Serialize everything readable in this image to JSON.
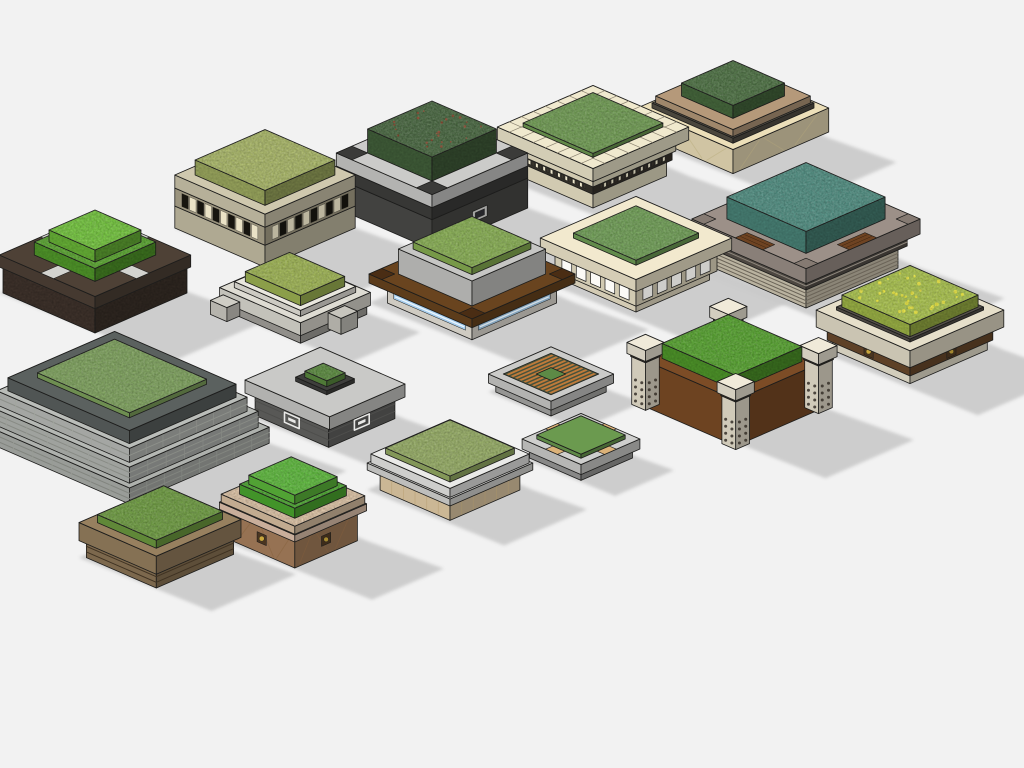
{
  "scene": {
    "description": "Isometric 3D render of a collection of 18 square landscape planter models with grass and shrub tops",
    "background": "#f2f2f2",
    "shadow_color": "#c9c9c9",
    "edge_color": "#1d1d1c",
    "planters": [
      {
        "id": "beige-slat-band",
        "label": "beige planter with slat band",
        "cx": 265,
        "cy": 228,
        "tiers": [
          {
            "w": 49,
            "d": 49,
            "h": 22,
            "c": "#c7c0a6"
          },
          {
            "w": 49,
            "d": 49,
            "h": 18,
            "c": "#b0a88f",
            "studs": {
              "n": 5,
              "c1": "#17150f",
              "c2": "#eae2c6"
            }
          },
          {
            "w": 49,
            "d": 49,
            "h": 13,
            "c": "#cfc8ae"
          },
          {
            "w": 38,
            "d": 38,
            "h": 15,
            "c": "#a9b767",
            "tex": 1
          }
        ]
      },
      {
        "id": "charcoal-concrete",
        "label": "charcoal planter with concrete top ring",
        "cx": 432,
        "cy": 208,
        "tiers": [
          {
            "w": 52,
            "d": 52,
            "h": 30,
            "c": "#4b4b49",
            "plaque": {
              "c": "#a3a3a1"
            }
          },
          {
            "w": 52,
            "d": 52,
            "h": 12,
            "c": "#3e3e3c"
          },
          {
            "w": 52,
            "d": 52,
            "h": 13,
            "c": "#cbcbc9",
            "pads": {
              "s": 17,
              "c": "#3b3b39"
            }
          },
          {
            "w": 35,
            "d": 35,
            "h": 24,
            "c": "#47663f",
            "tex": 1,
            "dots": {
              "n": 24,
              "c": "#8a4a30",
              "r": 1.1
            }
          }
        ]
      },
      {
        "id": "cream-tile",
        "label": "cream classical planter with tile border",
        "cx": 593,
        "cy": 176,
        "tiers": [
          {
            "w": 40,
            "d": 40,
            "h": 16,
            "c": "#ede6c9"
          },
          {
            "w": 43,
            "d": 43,
            "h": 9,
            "c": "#39352d",
            "studs": {
              "n": 9,
              "c1": "#efe8cd",
              "c2": "#39352d"
            }
          },
          {
            "w": 45,
            "d": 45,
            "h": 7,
            "c": "#ede6c9"
          },
          {
            "w": 47,
            "d": 47,
            "h": 4,
            "c": "#46423a"
          },
          {
            "w": 52,
            "d": 52,
            "h": 13,
            "c": "#f0e9ce",
            "tiles": {
              "ti": 38,
              "n": 8,
              "c": "#8a8270"
            }
          },
          {
            "w": 38,
            "d": 38,
            "h": 4,
            "c": "#6f9b52",
            "tex": 1
          }
        ]
      },
      {
        "id": "faceted-pedestal",
        "label": "faceted cream pedestal planter",
        "cx": 733,
        "cy": 138,
        "tiers": [
          {
            "w": 26,
            "d": 26,
            "h": 6,
            "c": "#e6dab2"
          },
          {
            "w": 52,
            "d": 52,
            "h": 24,
            "c": "#ecdfb9",
            "facets": {
              "c": "#c4b88f"
            }
          },
          {
            "w": 44,
            "d": 44,
            "h": 5,
            "c": "#544f45"
          },
          {
            "w": 42,
            "d": 42,
            "h": 7,
            "c": "#b5997a"
          },
          {
            "w": 28,
            "d": 28,
            "h": 13,
            "c": "#4c7042",
            "tex": 1
          }
        ]
      },
      {
        "id": "teal-mosaic",
        "label": "taupe planter with teal shrubs and wood strips",
        "cx": 806,
        "cy": 268,
        "tiers": [
          {
            "w": 50,
            "d": 50,
            "h": 22,
            "c": "#d2cab5",
            "stripes": {
              "n": 5,
              "c": "#6b6458"
            }
          },
          {
            "w": 55,
            "d": 55,
            "h": 12,
            "c": "#57514a",
            "stripes": {
              "n": 2,
              "c": "#8d867c"
            }
          },
          {
            "w": 62,
            "d": 62,
            "h": 15,
            "c": "#9c9088",
            "strips": {
              "len": 30,
              "wd": 13,
              "c": "#6e4322",
              "lines": "#3c2410"
            },
            "pads": {
              "s": 13,
              "c": "#857a72"
            }
          },
          {
            "w": 43,
            "d": 43,
            "h": 22,
            "c": "#4f8d80",
            "tex": 1
          }
        ]
      },
      {
        "id": "soil-cross",
        "label": "dark soil planter with stone cross paths",
        "cx": 95,
        "cy": 293,
        "tiers": [
          {
            "w": 50,
            "d": 50,
            "h": 26,
            "c": "#463931",
            "texS": 1
          },
          {
            "w": 52,
            "d": 52,
            "h": 12,
            "c": "#4e4136",
            "cross": {
              "wd": 14,
              "c": "#d3d3cf"
            }
          },
          {
            "w": 33,
            "d": 33,
            "h": 13,
            "c": "#58a52e",
            "tex": 1
          },
          {
            "w": 25,
            "d": 25,
            "h": 12,
            "c": "#72c43c",
            "tex": 1
          }
        ]
      },
      {
        "id": "white-low-steps",
        "label": "low white planter with steps",
        "cx": 295,
        "cy": 312,
        "tiers": [
          {
            "w": 42,
            "d": 36,
            "h": 9,
            "c": "#a5a39d"
          },
          {
            "w": 44,
            "d": 38,
            "h": 13,
            "c": "#dedcd3"
          },
          {
            "w": 36,
            "d": 30,
            "h": 6,
            "c": "#e9e7de"
          },
          {
            "w": 30,
            "d": 24,
            "h": 10,
            "c": "#9eb453",
            "tex": 1
          }
        ],
        "blocks": [
          {
            "a": -34,
            "b": 42,
            "w": 9,
            "d": 7,
            "h": 14,
            "c": "#cfcdc5"
          },
          {
            "a": 46,
            "b": -6,
            "w": 7,
            "d": 9,
            "h": 16,
            "c": "#c7c5bd"
          }
        ]
      },
      {
        "id": "wood-led",
        "label": "wood frame planter with LED strip base",
        "cx": 472,
        "cy": 303,
        "tiers": [
          {
            "w": 46,
            "d": 46,
            "h": 20,
            "c": "#ebe7dd",
            "band": {
              "c": "#a9cfee",
              "core": "#eaf5fd"
            }
          },
          {
            "w": 56,
            "d": 56,
            "h": 9,
            "c": "#69441f",
            "pads": {
              "s": 14,
              "c": "#4a2d14"
            }
          },
          {
            "w": 40,
            "d": 40,
            "h": 25,
            "c": "#c6c6c4"
          },
          {
            "w": 32,
            "d": 32,
            "h": 7,
            "c": "#87ae52",
            "tex": 1
          }
        ]
      },
      {
        "id": "cream-arcade",
        "label": "cream planter with arched arcade",
        "cx": 636,
        "cy": 280,
        "tiers": [
          {
            "w": 40,
            "d": 40,
            "h": 9,
            "c": "#f0e7cc"
          },
          {
            "w": 44,
            "d": 44,
            "h": 21,
            "c": "#eee5ca",
            "arches": {
              "n": 5,
              "c": "#fbfaf6"
            }
          },
          {
            "w": 52,
            "d": 52,
            "h": 12,
            "c": "#f2e9ce"
          },
          {
            "w": 34,
            "d": 34,
            "h": 5,
            "c": "#6f9e55",
            "tex": 1
          }
        ]
      },
      {
        "id": "wood-pillars",
        "label": "wood planter with stone corner pillars",
        "cx": 732,
        "cy": 406,
        "tiers": [
          {
            "w": 52,
            "d": 48,
            "h": 46,
            "c": "#7c4c26"
          },
          {
            "w": 40,
            "d": 36,
            "h": 15,
            "c": "#55a22e",
            "tex": 1
          }
        ],
        "posts": {
          "s": 15,
          "h": 62,
          "c": "#ece5d2",
          "at": [
            {
              "a": -49,
              "b": -45,
              "z": "back"
            },
            {
              "a": 49,
              "b": -45,
              "z": "mid",
              "holes": 1
            },
            {
              "a": -49,
              "b": 45,
              "z": "mid",
              "holes": 1
            },
            {
              "a": 49,
              "b": 45,
              "z": "front",
              "holes": 1
            }
          ]
        }
      },
      {
        "id": "travertine-flowers",
        "label": "travertine planter with flowering lawn",
        "cx": 910,
        "cy": 350,
        "tiers": [
          {
            "w": 42,
            "d": 42,
            "h": 10,
            "c": "#efe9d6"
          },
          {
            "w": 45,
            "d": 45,
            "h": 13,
            "c": "#6b4a2c",
            "medallion": {
              "c": "#c9a63c"
            }
          },
          {
            "w": 51,
            "d": 51,
            "h": 17,
            "c": "#e6dfca"
          },
          {
            "w": 40,
            "d": 40,
            "h": 3,
            "c": "#55504a"
          },
          {
            "w": 37,
            "d": 37,
            "h": 12,
            "c": "#a9c24c",
            "tex": 1,
            "dots": {
              "n": 34,
              "c": "#e9e53f",
              "r": 1.5
            }
          }
        ]
      },
      {
        "id": "stone-pyramid",
        "label": "stepped stone pyramid planter",
        "cx": 122,
        "cy": 440,
        "tiers": [
          {
            "w": 84,
            "d": 76,
            "h": 16,
            "c": "#aeb1ad",
            "stripes": {
              "n": 2,
              "c": "#82857f"
            },
            "panels": {
              "n": 7,
              "c": "#989b95"
            }
          },
          {
            "w": 78,
            "d": 70,
            "h": 16,
            "c": "#b5b8b4",
            "stripes": {
              "n": 2,
              "c": "#888b85"
            },
            "panels": {
              "n": 6,
              "c": "#9da09a"
            }
          },
          {
            "w": 72,
            "d": 64,
            "h": 14,
            "c": "#babdb9",
            "stripes": {
              "n": 1,
              "c": "#8d908a"
            },
            "panels": {
              "n": 6,
              "c": "#a2a59f"
            }
          },
          {
            "w": 66,
            "d": 58,
            "h": 13,
            "c": "#5b615f"
          },
          {
            "w": 50,
            "d": 42,
            "h": 5,
            "c": "#7da15c",
            "tex": 1
          }
        ]
      },
      {
        "id": "concrete-inset",
        "label": "concrete slab planter with inset shrub",
        "cx": 325,
        "cy": 417,
        "tiers": [
          {
            "w": 40,
            "d": 36,
            "h": 22,
            "c": "#646462",
            "stripes": {
              "n": 2,
              "c": "#4e4e4c"
            },
            "plaque": {
              "c": "#e8e8e6",
              "key": 1
            },
            "plaqueL": 1
          },
          {
            "w": 46,
            "d": 41,
            "h": 13,
            "c": "#c9c9c7"
          },
          {
            "w": 17,
            "d": 15,
            "h": 4,
            "c": "#3f3f3d"
          },
          {
            "w": 12,
            "d": 10,
            "h": 6,
            "c": "#5a8a3e",
            "tex": 1
          }
        ]
      },
      {
        "id": "wood-lattice",
        "label": "flat planter with wood slat lattice",
        "cx": 551,
        "cy": 392,
        "tiers": [
          {
            "w": 30,
            "d": 30,
            "h": 9,
            "c": "#a9a9a7"
          },
          {
            "w": 34,
            "d": 34,
            "h": 9,
            "c": "#cbcbc9",
            "lattice": {
              "iw": 26,
              "idp": 26,
              "wood": "#bf7a3a",
              "gap": "#46523c",
              "center": "#5d8a46",
              "cw": 8
            }
          }
        ]
      },
      {
        "id": "frame-clips",
        "label": "gray frame planter with timber clips",
        "cx": 581,
        "cy": 458,
        "tiers": [
          {
            "w": 28,
            "d": 28,
            "h": 9,
            "c": "#9b9b99"
          },
          {
            "w": 32,
            "d": 32,
            "h": 10,
            "c": "#cfcfcd",
            "strips": {
              "len": 13,
              "wd": 8,
              "c": "#dcb278"
            }
          },
          {
            "w": 24,
            "d": 24,
            "h": 4,
            "c": "#6b9a4f"
          }
        ]
      },
      {
        "id": "brown-grass",
        "label": "brown banded planter with lawn",
        "cx": 160,
        "cy": 556,
        "tiers": [
          {
            "w": 38,
            "d": 42,
            "h": 17,
            "c": "#8d7657",
            "stripes": {
              "n": 2,
              "c": "#3f3222"
            }
          },
          {
            "w": 42,
            "d": 46,
            "h": 18,
            "c": "#97805f"
          },
          {
            "w": 32,
            "d": 36,
            "h": 8,
            "c": "#6d9b40",
            "tex": 1
          }
        ]
      },
      {
        "id": "quilted-mound",
        "label": "quilted tan planter with shrub mound",
        "cx": 293,
        "cy": 540,
        "tiers": [
          {
            "w": 36,
            "d": 34,
            "h": 30,
            "c": "#aa825e",
            "medallion": {
              "c": "#c9a63c"
            },
            "facets": {
              "c": "#8e6a48"
            }
          },
          {
            "w": 41,
            "d": 39,
            "h": 7,
            "c": "#e4c6b0"
          },
          {
            "w": 40,
            "d": 38,
            "h": 8,
            "c": "#dcc2a4",
            "tex": 1
          },
          {
            "w": 30,
            "d": 28,
            "h": 10,
            "c": "#4ba72f",
            "tex": 1
          },
          {
            "w": 25,
            "d": 23,
            "h": 9,
            "c": "#5cb83b",
            "tex": 1
          }
        ]
      },
      {
        "id": "white-stone-base",
        "label": "white planter on tan stone base",
        "cx": 450,
        "cy": 490,
        "tiers": [
          {
            "w": 38,
            "d": 38,
            "h": 20,
            "c": "#e7d0a9",
            "panels": {
              "n": 5,
              "c": "#bfa87f"
            }
          },
          {
            "w": 45,
            "d": 45,
            "h": 7,
            "c": "#d8d8d6"
          },
          {
            "w": 43,
            "d": 43,
            "h": 9,
            "c": "#eaeae8"
          },
          {
            "w": 35,
            "d": 35,
            "h": 6,
            "c": "#95ac64",
            "tex": 1
          }
        ]
      }
    ]
  }
}
